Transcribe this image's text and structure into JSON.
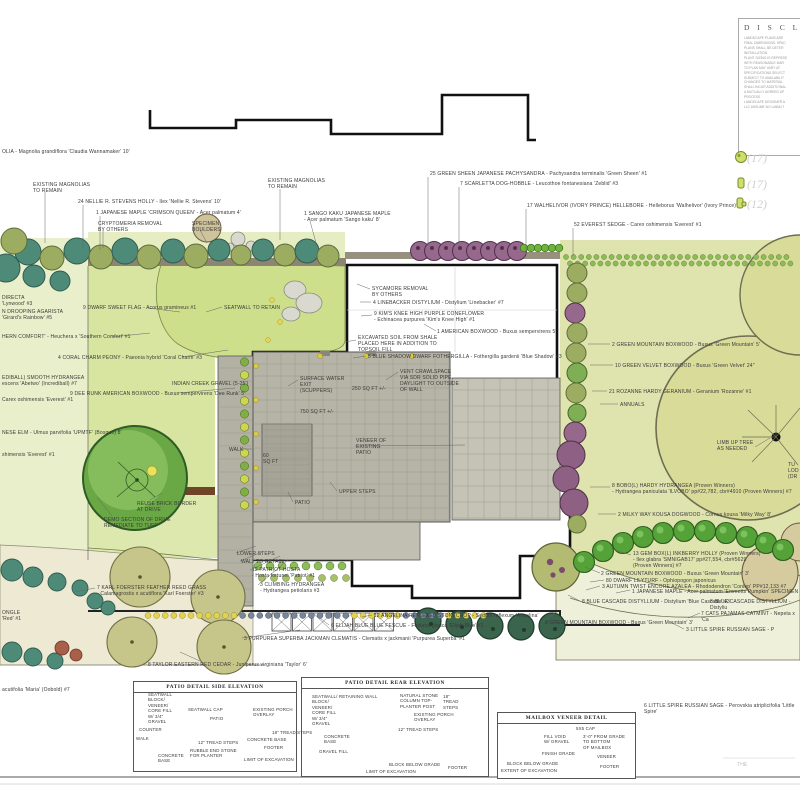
{
  "disclaimer": {
    "title": "D I S C L A I M E R",
    "lines": [
      "LANDSCAPE PLANS ARE",
      "FINAL DIMENSIONS, SPAC",
      "PLANS SHALL BE DETER",
      "INSTALLATION.",
      " ",
      "PLANT SIZING IS REPRESE",
      "WITH REASONABLE MAR",
      "TO PLAN MAY VARY AT",
      "SPECIFICATIONS SELECT",
      "SUBJECT TO AVAILABILIT",
      "CHANGES TO MATERIAL",
      "SHALL INCUR ADDITIONAL",
      "A MUTUALLY AGREED UP",
      "PROCESS.",
      " ",
      "LANDSCAPE DESIGNER A",
      "LLC ASSUME NO LIABILIT"
    ]
  },
  "legend": {
    "items": [
      {
        "icon": "shrub-round-icon",
        "count": "(17)"
      },
      {
        "icon": "shrub-square-icon",
        "count": "(17)"
      },
      {
        "icon": "shrub-notch-icon",
        "count": "(12)"
      }
    ]
  },
  "plan": {
    "labels": [
      {
        "x": 2,
        "y": 149,
        "t": "OLIA - Magnolia grandiflora 'Claudia Wannamaker' 10'"
      },
      {
        "x": 33,
        "y": 182,
        "t": "EXISTING MAGNOLIAS\nTO REMAIN"
      },
      {
        "x": 78,
        "y": 199,
        "t": "24 NELLIE R. STEVENS HOLLY - Ilex 'Nellie R. Stevens' 10'"
      },
      {
        "x": 96,
        "y": 210,
        "t": "1 JAPANESE MAPLE 'CRIMSON QUEEN' - Acer palmatum 4'"
      },
      {
        "x": 98,
        "y": 221,
        "t": "CRYPTOMERIA REMOVAL\nBY OTHERS"
      },
      {
        "x": 192,
        "y": 221,
        "t": "SPECIMEN\nBOULDERS"
      },
      {
        "x": 268,
        "y": 178,
        "t": "EXISTING MAGNOLIAS\nTO REMAIN"
      },
      {
        "x": 304,
        "y": 211,
        "t": "1 SANGO KAKU JAPANESE MAPLE\n- Acer palmatum 'Sango kaku' 8'"
      },
      {
        "x": 430,
        "y": 171,
        "t": "25 GREEN SHEEN JAPANESE PACHYSANDRA - Pachysandra terminalis 'Green Sheen' #1"
      },
      {
        "x": 460,
        "y": 181,
        "t": "7 SCARLETTA DOG-HOBBLE - Leucothoe fontanesiana 'Zeblid' #3"
      },
      {
        "x": 527,
        "y": 203,
        "t": "17 WALHELIVOR (IVORY PRINCE) HELLEBORE - Helleborus 'Walhelivor' (Ivory Prince)'"
      },
      {
        "x": 574,
        "y": 222,
        "t": "52 EVEREST SEDGE - Carex oshimensis 'Everest' #1"
      },
      {
        "x": 2,
        "y": 295,
        "t": "DIRECTA\n'Lynwood' #3"
      },
      {
        "x": 2,
        "y": 309,
        "t": "N DROOPING AGARISTA\n'Girard's Rainbow' #5"
      },
      {
        "x": 2,
        "y": 334,
        "t": "HERN COMFORT' - Heuchera x 'Southern Comfort' #1"
      },
      {
        "x": 83,
        "y": 305,
        "t": "9 DWARF SWEET FLAG - Acorus gramineus #1"
      },
      {
        "x": 224,
        "y": 305,
        "t": "SEATWALL TO RETAIN"
      },
      {
        "x": 58,
        "y": 355,
        "t": "4 CORAL CHARM PEONY - Paeonia hybrid 'Coral Charm' #3"
      },
      {
        "x": 2,
        "y": 375,
        "t": "EDIBALL) SMOOTH HYDRANGEA\nescens 'Abetwo' (Incrediball) #7"
      },
      {
        "x": 70,
        "y": 391,
        "t": "9 DEE RUNK AMERICAN BOXWOOD - Buxus sempervirens 'Dee Runk' 5'"
      },
      {
        "x": 2,
        "y": 397,
        "t": "Carex oshimensis 'Everest' #1"
      },
      {
        "x": 172,
        "y": 381,
        "t": "INDIAN CREEK GRAVEL (5-25')"
      },
      {
        "x": 2,
        "y": 430,
        "t": "NESE ELM - Ulmus parvifolia 'UPMTF' (Bosque) 8'"
      },
      {
        "x": 2,
        "y": 452,
        "t": "shimensis 'Everest' #1"
      },
      {
        "x": 372,
        "y": 286,
        "t": "SYCAMORE REMOVAL\nBY OTHERS"
      },
      {
        "x": 373,
        "y": 300,
        "t": "4 LINEBACKER DISTYLIUM - Distylium 'Linebacker'  #7"
      },
      {
        "x": 374,
        "y": 311,
        "t": "9 KIM'S KNEE HIGH PURPLE CONEFLOWER\n- Echinacea purpurea 'Kim's Knee High' #1"
      },
      {
        "x": 437,
        "y": 329,
        "t": "1 AMERICAN BOXWOOD - Buxus sempervirens 5'"
      },
      {
        "x": 358,
        "y": 335,
        "t": "EXCAVATED SOIL FROM SHALE\nPLACED HERE IN ADDITION TO\nTOPSOIL FILL"
      },
      {
        "x": 368,
        "y": 354,
        "t": "5 BLUE SHADOW DWARF FOTHERGILLA - Fothergilla gardenii 'Blue Shadow' #3"
      },
      {
        "x": 400,
        "y": 369,
        "t": "VENT CRAWLSPACE\nVIA SDR SOLID PIPE\nDAYLIGHT TO OUTSIDE\nOF WALL"
      },
      {
        "x": 352,
        "y": 386,
        "t": "250 SQ FT +/-"
      },
      {
        "x": 300,
        "y": 376,
        "t": "SURFACE WATER\nEXIT\n(SCUPPERS)"
      },
      {
        "x": 300,
        "y": 409,
        "t": "750 SQ FT +/-"
      },
      {
        "x": 356,
        "y": 438,
        "t": "VENEER OF\nEXISTING\nPATIO"
      },
      {
        "x": 229,
        "y": 447,
        "t": "WALK"
      },
      {
        "x": 263,
        "y": 453,
        "t": "60\nSQ FT"
      },
      {
        "x": 339,
        "y": 489,
        "t": "UPPER STEPS"
      },
      {
        "x": 295,
        "y": 500,
        "t": "PATIO"
      },
      {
        "x": 612,
        "y": 342,
        "t": "2 GREEN MOUNTAIN BOXWOOD - Buxus 'Green Mountain' 5'"
      },
      {
        "x": 615,
        "y": 363,
        "t": "10 GREEN VELVET BOXWOOD - Buxus 'Green Velvet' 24\""
      },
      {
        "x": 609,
        "y": 389,
        "t": "21 ROZANNE HARDY GERANIUM - Geranium 'Rozanne' #1"
      },
      {
        "x": 620,
        "y": 402,
        "t": "ANNUALS"
      },
      {
        "x": 717,
        "y": 440,
        "t": "LIMB UP TREE\nAS NEEDED"
      },
      {
        "x": 788,
        "y": 462,
        "t": "TU\nLOD\n(DR"
      },
      {
        "x": 612,
        "y": 483,
        "t": "8 BOBO(L) HARDY HYDRANGEA (Proven Winners)\n- Hydrangea paniculata 'ILVOBO' pp#22,782, cbr#4910 (Proven Winners) #7"
      },
      {
        "x": 618,
        "y": 512,
        "t": "2 MILKY WAY KOUSA DOGWOOD - Cornus kousa 'Milky Way' 8'"
      },
      {
        "x": 633,
        "y": 551,
        "t": "13 GEM BOX(L) INKBERRY HOLLY (Proven Winners)\n- Ilex glabra 'SMNIGAB17' pp#27,554, cbr#5629\n(Proven Winners) #7"
      },
      {
        "x": 601,
        "y": 571,
        "t": "2 GREEN MOUNTAIN BOXWOOD - Buxus 'Green Mountain' 3'"
      },
      {
        "x": 606,
        "y": 578,
        "t": "80 DWARF LILYTURF - Ophiopogon japonicus"
      },
      {
        "x": 602,
        "y": 584,
        "t": "3 AUTUMN TWIST ENCORE AZALEA - Rhododendron 'Conlep' PP#12,133 #7"
      },
      {
        "x": 632,
        "y": 589,
        "t": "1 JAPANESE MAPLE - Acer palmatum 'Emmetts Pumpkin' SPECIMEN"
      },
      {
        "x": 582,
        "y": 599,
        "t": "8 BLUE CASCADE DISTYLLIUM - Distylium 'Blue Cascade' #3"
      },
      {
        "x": 710,
        "y": 599,
        "t": "8 BLUE CASCADE DISTYLLIUM - Distyliu"
      },
      {
        "x": 701,
        "y": 611,
        "t": "7 CATS PAJAMAS CATMINT - Nepeta x 'Ca"
      },
      {
        "x": 545,
        "y": 620,
        "t": "8 GREEN MOUNTAIN BOXWOOD - Buxus 'Green Mountain' 3'"
      },
      {
        "x": 686,
        "y": 627,
        "t": "3 LITTLE SPIRE RUSSIAN SAGE - P"
      },
      {
        "x": 237,
        "y": 551,
        "t": "LOWER STEPS"
      },
      {
        "x": 241,
        "y": 559,
        "t": "WALL TO RETAIN"
      },
      {
        "x": 252,
        "y": 567,
        "t": "12 PATRIOT HOSTA\n- Hosta fortunei 'Patriot' #1"
      },
      {
        "x": 260,
        "y": 582,
        "t": "3 CLIMBING HYDRANGEA\n- Hydrangea petiolaris #3"
      },
      {
        "x": 374,
        "y": 613,
        "t": "12 ANGELINA REFLEXED STONECROP - Sedum reflexum 'Angelina'"
      },
      {
        "x": 331,
        "y": 623,
        "t": "6 ELIJAH BLUE BLUE FESCUE - Festuca glauca 'Elijah Blue' #1"
      },
      {
        "x": 244,
        "y": 636,
        "t": "3 PURPUREA SUPERBA JACKMAN CLEMATIS - Clematis x jackmanii 'Purpurea Superba' #1"
      },
      {
        "x": 97,
        "y": 585,
        "t": "7 KARL FOERSTER FEATHER REED GRASS\n- Calamagrostis x acutiflora 'Karl Foerster' #3"
      },
      {
        "x": 148,
        "y": 662,
        "t": "8 TAYLOR EASTERN RED CEDAR - Juniperus virginiana 'Taylor' 6'"
      },
      {
        "x": 2,
        "y": 610,
        "t": "ONGLE\n'Red' #1"
      },
      {
        "x": 2,
        "y": 687,
        "t": "acutifolia 'Maria' (Oobold) #7"
      },
      {
        "x": 137,
        "y": 501,
        "t": "REUSE BRICK BORDER\nAT DRIVE"
      },
      {
        "x": 104,
        "y": 517,
        "t": "DEMO SECTION OF DRIVE\nREMEDIATE TO TURF"
      },
      {
        "x": 644,
        "y": 703,
        "t": "6 LITTLE SPIRE RUSSIAN SAGE - Perovskia atriplicifolia 'Little Spire'"
      },
      {
        "x": 737,
        "y": 762,
        "t": "THE",
        "cls": "faint"
      }
    ]
  },
  "details": {
    "side": {
      "title": "PATIO DETAIL SIDE ELEVATION",
      "labels": [
        {
          "x": 148,
          "y": 692,
          "t": "SEATWALL\nBLOCK/\nVENEER/\nCORE FILL\nW/ 3/4\"\nGRAVEL"
        },
        {
          "x": 188,
          "y": 707,
          "t": "SEATWALL CAP"
        },
        {
          "x": 210,
          "y": 716,
          "t": "PATIO"
        },
        {
          "x": 253,
          "y": 707,
          "t": "EXISTING PORCH\nOVERLAY"
        },
        {
          "x": 139,
          "y": 727,
          "t": "COUNTER"
        },
        {
          "x": 136,
          "y": 736,
          "t": "WALK"
        },
        {
          "x": 198,
          "y": 740,
          "t": "12\" TREAD STEPS"
        },
        {
          "x": 272,
          "y": 730,
          "t": "18\" TREAD STEPS"
        },
        {
          "x": 247,
          "y": 737,
          "t": "CONCRETE BASE"
        },
        {
          "x": 264,
          "y": 745,
          "t": "FOOTER"
        },
        {
          "x": 190,
          "y": 748,
          "t": "RUBBLE END STONE\nFOR PLANTER"
        },
        {
          "x": 158,
          "y": 753,
          "t": "CONCRETE\nBASE"
        },
        {
          "x": 244,
          "y": 757,
          "t": "LIMIT OF EXCAVATION"
        }
      ]
    },
    "rear": {
      "title": "PATIO DETAIL REAR ELEVATION",
      "labels": [
        {
          "x": 312,
          "y": 694,
          "t": "SEATWALL/ RETAINING WALL\nBLOCK/\nVENEER/\nCORE FILL\nW/ 3/4\"\nGRAVEL"
        },
        {
          "x": 400,
          "y": 693,
          "t": "NATURAL STONE\nCOLUMN TOP-\nPLANTER POST"
        },
        {
          "x": 443,
          "y": 694,
          "t": "18\"\nTREAD\nSTEPS"
        },
        {
          "x": 414,
          "y": 712,
          "t": "EXISTING PORCH\nOVERLAY"
        },
        {
          "x": 398,
          "y": 727,
          "t": "12\" TREAD STEPS"
        },
        {
          "x": 324,
          "y": 734,
          "t": "CONCRETE\nBASE"
        },
        {
          "x": 319,
          "y": 749,
          "t": "GRAVEL FILL"
        },
        {
          "x": 389,
          "y": 762,
          "t": "BLOCK BELOW GRADE"
        },
        {
          "x": 448,
          "y": 765,
          "t": "FOOTER"
        },
        {
          "x": 366,
          "y": 769,
          "t": "LIMIT OF EXCAVATION"
        }
      ]
    },
    "mailbox": {
      "title": "MAILBOX VENEER DETAIL",
      "labels": [
        {
          "x": 576,
          "y": 726,
          "t": "5X5 CAP"
        },
        {
          "x": 544,
          "y": 734,
          "t": "FILL VOID\nW/ GRAVEL"
        },
        {
          "x": 583,
          "y": 734,
          "t": "3'-0\" FROM GRADE\nTO BOTTOM\nOF MAILBOX"
        },
        {
          "x": 542,
          "y": 751,
          "t": "FINISH GRADE"
        },
        {
          "x": 597,
          "y": 754,
          "t": "VENEER"
        },
        {
          "x": 507,
          "y": 761,
          "t": "BLOCK BELOW GRADE"
        },
        {
          "x": 600,
          "y": 764,
          "t": "FOOTER"
        },
        {
          "x": 501,
          "y": 768,
          "t": "EXTENT OF EXCAVATION"
        }
      ]
    }
  },
  "colors": {
    "lawn": "#d8e5a0",
    "lawn_bright": "#cddf8b",
    "lawn_right": "#dfe3ae",
    "bed": "#e9efca",
    "bed_top": "#e6edc2",
    "cream": "#eee9d2",
    "teal_tree": "#4e8a78",
    "olive_tree": "#9cad62",
    "purple_shrub": "#96688c",
    "green_ball": "#55a238",
    "cedar": "#3a644c",
    "patio_grey": "#b5b4a6",
    "veneer_grey": "#c5c3b5",
    "wall_brown": "#6e4526",
    "big_tree": "#d9dc99",
    "tan_tree": "#cec39a",
    "yellow_dot": "#e3d24b",
    "blue_dot": "#76879b",
    "accent_legend": "#cde06a"
  }
}
